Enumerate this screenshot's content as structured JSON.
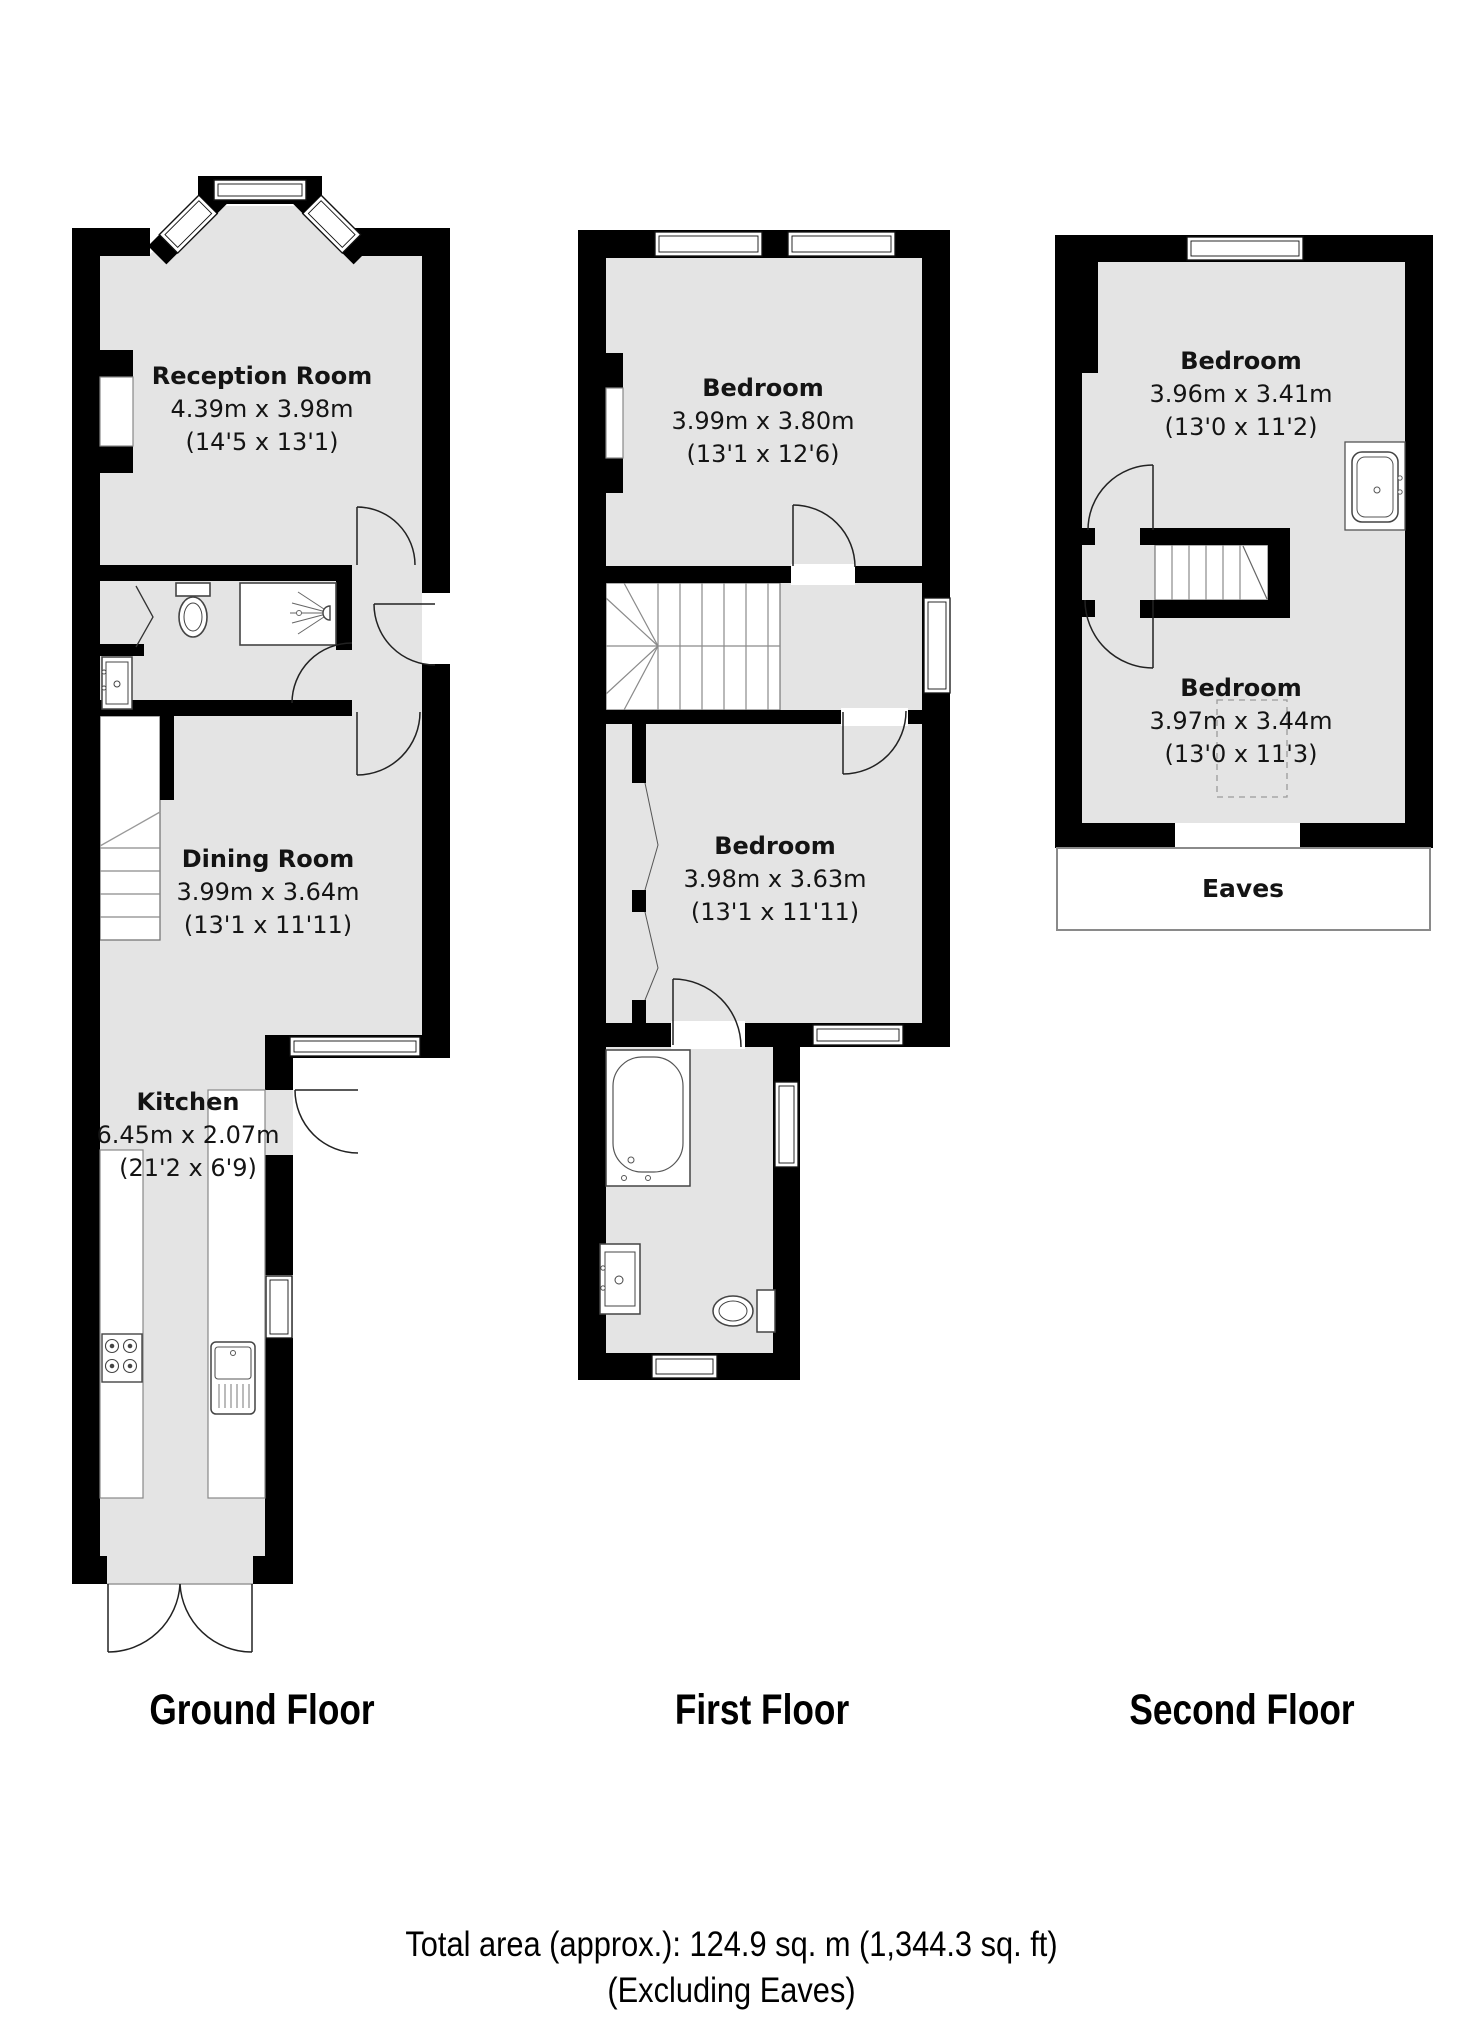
{
  "colors": {
    "floor_fill": "#e4e4e4",
    "wall": "#000000",
    "line": "#222222"
  },
  "floors": {
    "ground": {
      "label": "Ground Floor",
      "rooms": {
        "reception": {
          "name": "Reception Room",
          "metric": "4.39m x 3.98m",
          "imperial": "(14'5 x 13'1)"
        },
        "dining": {
          "name": "Dining Room",
          "metric": "3.99m x 3.64m",
          "imperial": "(13'1 x 11'11)"
        },
        "kitchen": {
          "name": "Kitchen",
          "metric": "6.45m x 2.07m",
          "imperial": "(21'2 x 6'9)"
        }
      }
    },
    "first": {
      "label": "First Floor",
      "rooms": {
        "bedroom_front": {
          "name": "Bedroom",
          "metric": "3.99m x 3.80m",
          "imperial": "(13'1 x 12'6)"
        },
        "bedroom_back": {
          "name": "Bedroom",
          "metric": "3.98m x 3.63m",
          "imperial": "(13'1 x 11'11)"
        }
      }
    },
    "second": {
      "label": "Second Floor",
      "eaves_label": "Eaves",
      "rooms": {
        "bedroom_front": {
          "name": "Bedroom",
          "metric": "3.96m x 3.41m",
          "imperial": "(13'0 x 11'2)"
        },
        "bedroom_back": {
          "name": "Bedroom",
          "metric": "3.97m x 3.44m",
          "imperial": "(13'0 x 11'3)"
        }
      }
    }
  },
  "footer": {
    "total_area": "Total area (approx.): 124.9 sq. m (1,344.3 sq. ft)",
    "excluding": "(Excluding Eaves)"
  }
}
